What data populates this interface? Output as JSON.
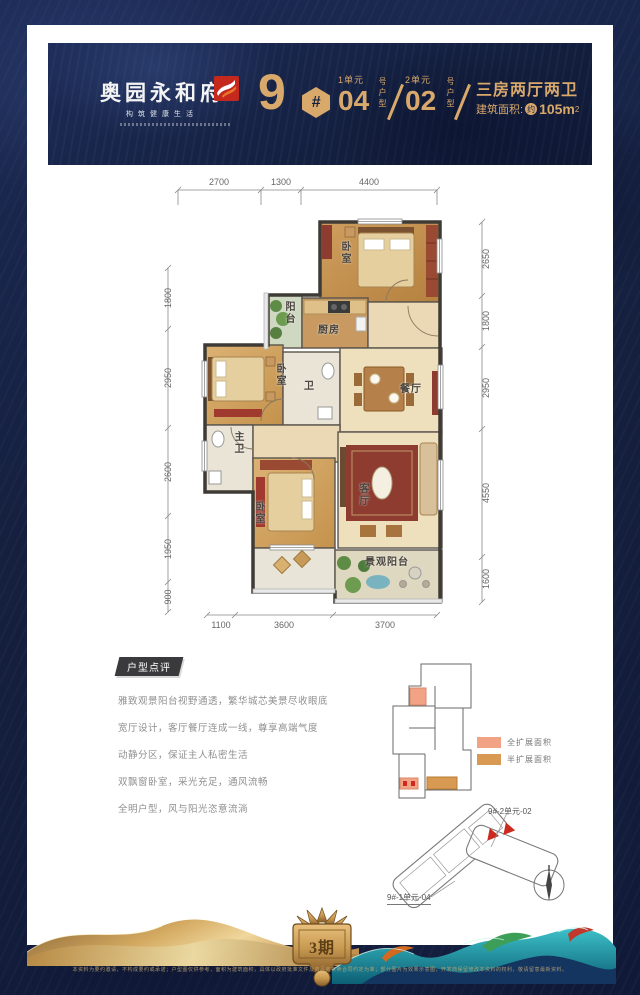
{
  "colors": {
    "background_navy": "#15203f",
    "accent_gold": "#d9a96c",
    "logo_red": "#c5281c",
    "legend_full": "#f2a285",
    "legend_half": "#d89a52",
    "highlight_red": "#cc2a1e"
  },
  "header": {
    "brand": "奥园永和府",
    "slogan": "构筑健康生活",
    "building_number": "9",
    "hash_symbol": "#",
    "units": [
      {
        "unit_label": "1单元",
        "type_number": "04",
        "type_suffix": "号户型"
      },
      {
        "unit_label": "2单元",
        "type_number": "02",
        "type_suffix": "号户型"
      }
    ],
    "layout_text": "三房两厅两卫",
    "area_label": "建筑面积:",
    "area_approx": "约",
    "area_value": "105m",
    "area_exponent": "2"
  },
  "floorplan": {
    "dims_top": [
      "2700",
      "1300",
      "4400"
    ],
    "dims_left": [
      "1800",
      "2950",
      "2600",
      "1950",
      "900"
    ],
    "dims_right": [
      "2650",
      "1800",
      "2950",
      "4550",
      "1600"
    ],
    "dims_bottom": [
      "1100",
      "3600",
      "3700"
    ],
    "rooms": {
      "bedroom_top": "卧室",
      "balcony_top": "阳台",
      "kitchen": "厨房",
      "bedroom_mid": "卧室",
      "bath": "卫",
      "dining": "餐厅",
      "master_bath": "主卫",
      "bedroom_bottom": "卧室",
      "living": "客厅",
      "view_balcony": "景观阳台"
    }
  },
  "review": {
    "badge": "户型点评",
    "lines": [
      "雅致观景阳台视野通透，繁华城芯美景尽收眼底",
      "宽厅设计，客厅餐厅连成一线，尊享高端气度",
      "动静分区，保证主人私密生活",
      "双飘窗卧室，采光充足，通风流畅",
      "全明户型，风与阳光恣意流淌"
    ]
  },
  "expansion_legend": {
    "full": {
      "label": "全扩展面积",
      "css": "background:#f2a285"
    },
    "half": {
      "label": "半扩展面积",
      "css": "background:#d89a52"
    }
  },
  "site_plan": {
    "unit2_label": "9#-2单元-02",
    "unit1_label": "9#-1单元-04"
  },
  "footer": {
    "phase": "3期",
    "disclaimer": "本资料为要约邀请，不构成要约或承诺；户型图仅供参考，面积为建筑面积，具体以政府批准文件及商品房买卖合同约定为准；部分图片为效果示意图，开发商保留修改本资料的权利，敬请留意最新资料。"
  }
}
